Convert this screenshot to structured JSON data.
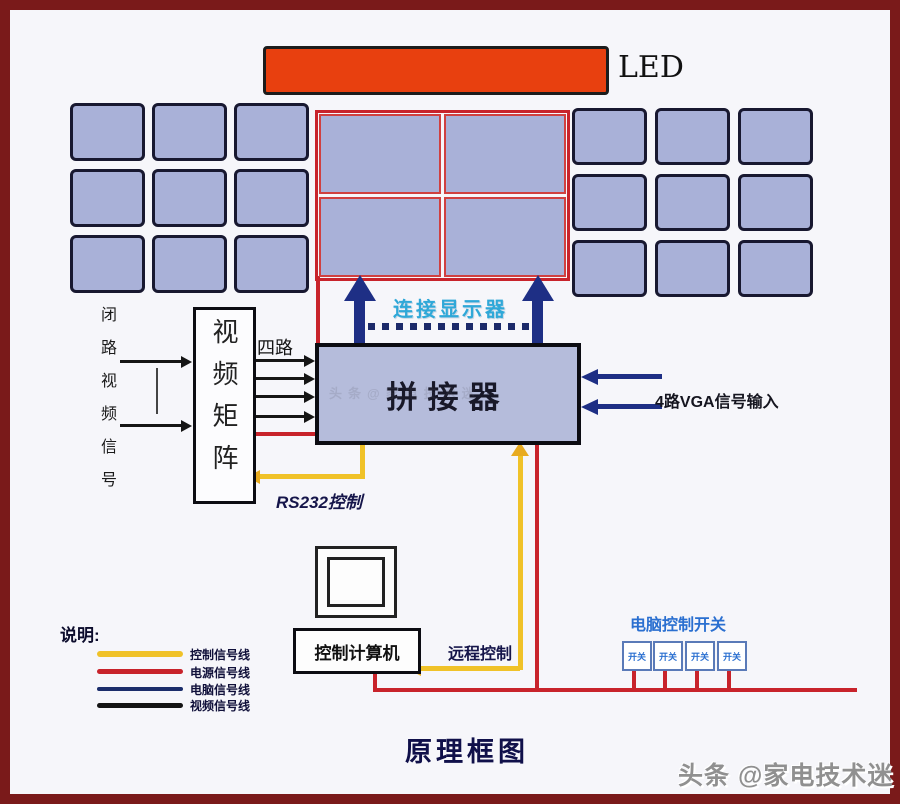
{
  "diagram": {
    "title": "原理框图",
    "watermark": "头条 @家电技术迷",
    "watermark_faint": "头条@家电技术迷"
  },
  "led": {
    "label": "LED",
    "bar_color": "#e8400f"
  },
  "wall": {
    "left_grid": {
      "rows": 3,
      "cols": 3
    },
    "right_grid": {
      "rows": 3,
      "cols": 3
    },
    "center_display": {
      "rows": 2,
      "cols": 2
    }
  },
  "nodes": {
    "splicer": "拼接器",
    "video_matrix": "视频矩阵",
    "control_computer": "控制计算机"
  },
  "annotations": {
    "connect_display": "连接显示器",
    "cctv_input": "闭路视频信号",
    "four_channel": "四路",
    "vga_input": "4路VGA信号输入",
    "rs232_control": "RS232控制",
    "remote_control": "远程控制",
    "power_switch_label": "电脑控制开关",
    "switch_text": "开关"
  },
  "legend": {
    "heading": "说明:",
    "items": [
      {
        "label": "控制信号线",
        "color": "#f0c228"
      },
      {
        "label": "电源信号线",
        "color": "#c8232b"
      },
      {
        "label": "电脑信号线",
        "color": "#1b2d6b"
      },
      {
        "label": "视频信号线",
        "color": "#141414"
      }
    ]
  },
  "colors": {
    "frame": "#7a1a1a",
    "canvas_bg": "#f6f6fa",
    "screen_fill": "#a9b1d8",
    "screen_border": "#181830",
    "red_line": "#c8232b",
    "yellow_line": "#f0c228",
    "navy": "#1e2f85",
    "cyan_text": "#2fa8d8",
    "blue_text": "#2a6fd0"
  }
}
